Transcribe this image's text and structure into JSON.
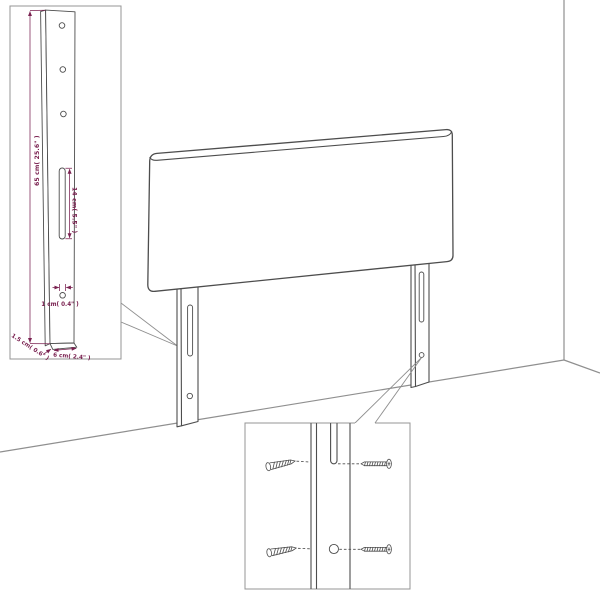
{
  "diagram": {
    "dims": {
      "height": "65 cm( 25.6\" )",
      "slot": "14 cm( 5.5\" )",
      "hole": "1 cm( 0.4\" )",
      "thickness": "1.5 cm( 0.6\" )",
      "width": "6 cm( 2.4\" )"
    }
  },
  "colors": {
    "dimension": "#7a2150",
    "outline": "#4d4d4d",
    "room": "#8f8f8f",
    "background": "#ffffff"
  }
}
